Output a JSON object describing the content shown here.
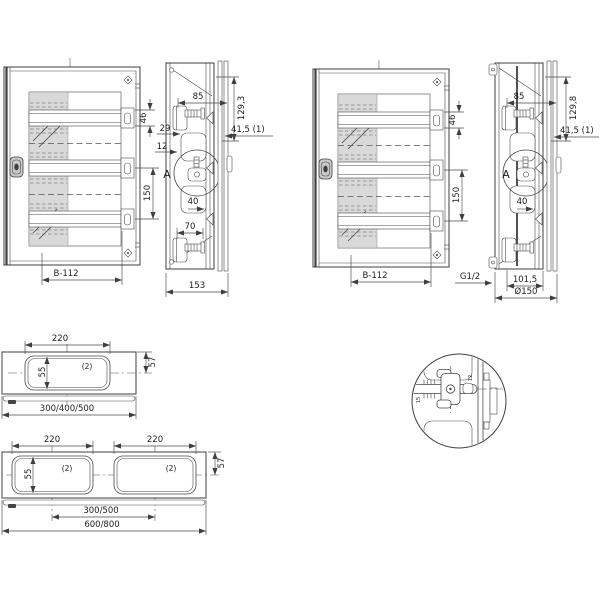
{
  "colors": {
    "line": "#3f3f3f",
    "glazing": "#d9d9d9",
    "background": "#ffffff"
  },
  "views": {
    "front_left": {
      "dim_rail_height": "46",
      "dim_rail_pitch": "150",
      "dim_width": "B-112"
    },
    "side_left": {
      "dim_depth_front": "85",
      "dim_height": "129,3",
      "dim_29": "29",
      "dim_door": "41,5 (1)",
      "dim_12": "12",
      "detail_ref": "A",
      "dim_40": "40",
      "dim_70": "70",
      "dim_total_depth": "153"
    },
    "front_right": {
      "dim_rail_height": "46",
      "dim_rail_pitch": "150",
      "dim_width": "B-112"
    },
    "side_right": {
      "dim_depth_front": "85",
      "dim_height": "129,8",
      "dim_door": "41,5 (1)",
      "detail_ref": "A",
      "dim_40": "40",
      "dim_gland": "G1/2",
      "dim_recess": "101,5",
      "dim_diameter": "Ø150"
    },
    "top_single": {
      "dim_cutout_width": "220",
      "dim_cutout_height": "55",
      "qty": "(2)",
      "dim_edge": "57",
      "dim_widths": "300/400/500"
    },
    "top_double": {
      "dim_cutout_width_left": "220",
      "dim_cutout_width_right": "220",
      "dim_cutout_height": "55",
      "qty_left": "(2)",
      "qty_right": "(2)",
      "dim_edge": "57",
      "dim_centers": "300/500",
      "dim_widths": "600/800"
    },
    "detail_a": {
      "dim_left": "15",
      "dim_right": "12"
    }
  }
}
